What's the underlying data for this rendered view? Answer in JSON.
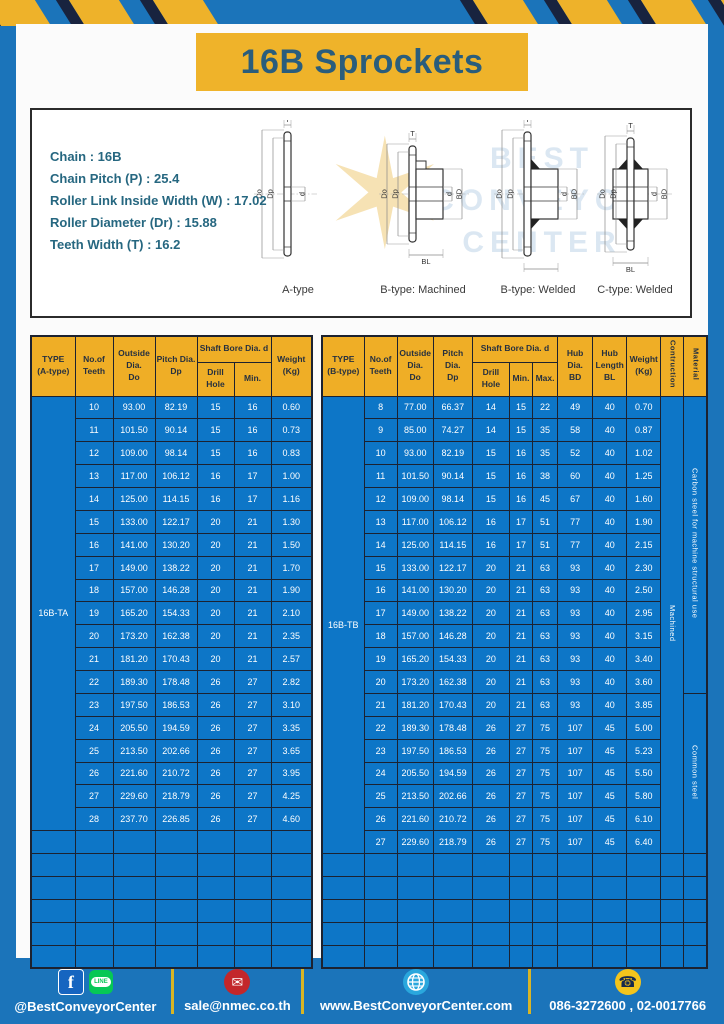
{
  "banner": {
    "title": "16B Sprockets"
  },
  "specs": {
    "lines": [
      "Chain : 16B",
      "Chain Pitch (P) : 25.4",
      "Roller Link Inside Width (W) : 17.02",
      "Roller Diameter (Dr) : 15.88",
      "Teeth Width (T) : 16.2"
    ]
  },
  "watermark": {
    "lines": [
      "BEST",
      "CONVEYOR",
      "CENTER"
    ]
  },
  "diagrams": {
    "dim_labels": {
      "t": "T",
      "dia_outer": "Do",
      "dia_pitch": "Dp",
      "bore": "d",
      "hub_dia": "BD",
      "hub_len": "BL"
    },
    "types": [
      {
        "label": "A-type"
      },
      {
        "label": "B-type: Machined"
      },
      {
        "label": "B-type: Welded"
      },
      {
        "label": "C-type: Welded"
      }
    ]
  },
  "table_a": {
    "headers": {
      "type": "TYPE\n(A-type)",
      "teeth": "No.of\nTeeth",
      "outside_dia": "Outside\nDia.\nDo",
      "pitch_dia": "Pitch Dia.\nDp",
      "shaft_bore": "Shaft Bore Dia. d",
      "drill_hole": "Drill Hole",
      "min": "Min.",
      "weight": "Weight\n(Kg)"
    },
    "type_value": "16B-TA",
    "rows": [
      [
        "10",
        "93.00",
        "82.19",
        "15",
        "16",
        "0.60"
      ],
      [
        "11",
        "101.50",
        "90.14",
        "15",
        "16",
        "0.73"
      ],
      [
        "12",
        "109.00",
        "98.14",
        "15",
        "16",
        "0.83"
      ],
      [
        "13",
        "117.00",
        "106.12",
        "16",
        "17",
        "1.00"
      ],
      [
        "14",
        "125.00",
        "114.15",
        "16",
        "17",
        "1.16"
      ],
      [
        "15",
        "133.00",
        "122.17",
        "20",
        "21",
        "1.30"
      ],
      [
        "16",
        "141.00",
        "130.20",
        "20",
        "21",
        "1.50"
      ],
      [
        "17",
        "149.00",
        "138.22",
        "20",
        "21",
        "1.70"
      ],
      [
        "18",
        "157.00",
        "146.28",
        "20",
        "21",
        "1.90"
      ],
      [
        "19",
        "165.20",
        "154.33",
        "20",
        "21",
        "2.10"
      ],
      [
        "20",
        "173.20",
        "162.38",
        "20",
        "21",
        "2.35"
      ],
      [
        "21",
        "181.20",
        "170.43",
        "20",
        "21",
        "2.57"
      ],
      [
        "22",
        "189.30",
        "178.48",
        "26",
        "27",
        "2.82"
      ],
      [
        "23",
        "197.50",
        "186.53",
        "26",
        "27",
        "3.10"
      ],
      [
        "24",
        "205.50",
        "194.59",
        "26",
        "27",
        "3.35"
      ],
      [
        "25",
        "213.50",
        "202.66",
        "26",
        "27",
        "3.65"
      ],
      [
        "26",
        "221.60",
        "210.72",
        "26",
        "27",
        "3.95"
      ],
      [
        "27",
        "229.60",
        "218.79",
        "26",
        "27",
        "4.25"
      ],
      [
        "28",
        "237.70",
        "226.85",
        "26",
        "27",
        "4.60"
      ]
    ],
    "empty_row_count": 6
  },
  "table_b": {
    "headers": {
      "type": "TYPE\n(B-type)",
      "teeth": "No.of\nTeeth",
      "outside_dia": "Outside\nDia.\nDo",
      "pitch_dia": "Pitch Dia.\nDp",
      "shaft_bore": "Shaft Bore Dia. d",
      "drill_hole": "Drill Hole",
      "min": "Min.",
      "max": "Max.",
      "hub_dia": "Hub Dia.\nBD",
      "hub_length": "Hub\nLength\nBL",
      "weight": "Weight\n(Kg)",
      "construction": "Contruction",
      "material": "Material"
    },
    "type_value": "16B-TB",
    "construction_value": "Machined",
    "material_values": [
      {
        "label": "Carbon steel for machine structural use",
        "row_span": 13
      },
      {
        "label": "Common steel",
        "row_span": 7
      }
    ],
    "rows": [
      [
        "8",
        "77.00",
        "66.37",
        "14",
        "15",
        "22",
        "49",
        "40",
        "0.70"
      ],
      [
        "9",
        "85.00",
        "74.27",
        "14",
        "15",
        "35",
        "58",
        "40",
        "0.87"
      ],
      [
        "10",
        "93.00",
        "82.19",
        "15",
        "16",
        "35",
        "52",
        "40",
        "1.02"
      ],
      [
        "11",
        "101.50",
        "90.14",
        "15",
        "16",
        "38",
        "60",
        "40",
        "1.25"
      ],
      [
        "12",
        "109.00",
        "98.14",
        "15",
        "16",
        "45",
        "67",
        "40",
        "1.60"
      ],
      [
        "13",
        "117.00",
        "106.12",
        "16",
        "17",
        "51",
        "77",
        "40",
        "1.90"
      ],
      [
        "14",
        "125.00",
        "114.15",
        "16",
        "17",
        "51",
        "77",
        "40",
        "2.15"
      ],
      [
        "15",
        "133.00",
        "122.17",
        "20",
        "21",
        "63",
        "93",
        "40",
        "2.30"
      ],
      [
        "16",
        "141.00",
        "130.20",
        "20",
        "21",
        "63",
        "93",
        "40",
        "2.50"
      ],
      [
        "17",
        "149.00",
        "138.22",
        "20",
        "21",
        "63",
        "93",
        "40",
        "2.95"
      ],
      [
        "18",
        "157.00",
        "146.28",
        "20",
        "21",
        "63",
        "93",
        "40",
        "3.15"
      ],
      [
        "19",
        "165.20",
        "154.33",
        "20",
        "21",
        "63",
        "93",
        "40",
        "3.40"
      ],
      [
        "20",
        "173.20",
        "162.38",
        "20",
        "21",
        "63",
        "93",
        "40",
        "3.60"
      ],
      [
        "21",
        "181.20",
        "170.43",
        "20",
        "21",
        "63",
        "93",
        "40",
        "3.85"
      ],
      [
        "22",
        "189.30",
        "178.48",
        "26",
        "27",
        "75",
        "107",
        "45",
        "5.00"
      ],
      [
        "23",
        "197.50",
        "186.53",
        "26",
        "27",
        "75",
        "107",
        "45",
        "5.23"
      ],
      [
        "24",
        "205.50",
        "194.59",
        "26",
        "27",
        "75",
        "107",
        "45",
        "5.50"
      ],
      [
        "25",
        "213.50",
        "202.66",
        "26",
        "27",
        "75",
        "107",
        "45",
        "5.80"
      ],
      [
        "26",
        "221.60",
        "210.72",
        "26",
        "27",
        "75",
        "107",
        "45",
        "6.10"
      ],
      [
        "27",
        "229.60",
        "218.79",
        "26",
        "27",
        "75",
        "107",
        "45",
        "6.40"
      ]
    ],
    "empty_row_count": 5
  },
  "footer": {
    "sections": [
      {
        "text": "@BestConveyorCenter"
      },
      {
        "text": "sale@nmec.co.th"
      },
      {
        "text": "www.BestConveyorCenter.com"
      },
      {
        "text": "086-3272600 , 02-0017766"
      }
    ],
    "icon_glyphs": {
      "facebook": "f",
      "line": "LINE",
      "email": "✉",
      "phone": "☎"
    }
  },
  "colors": {
    "frame_blue": "#1b74ba",
    "cell_blue": "#0d76c7",
    "header_yellow": "#efae26",
    "banner_yellow": "#efb32a",
    "border_dark": "#1c2230",
    "divider_yellow": "#d9b525",
    "title_text": "#2a5d7c",
    "spec_text": "#266780"
  }
}
